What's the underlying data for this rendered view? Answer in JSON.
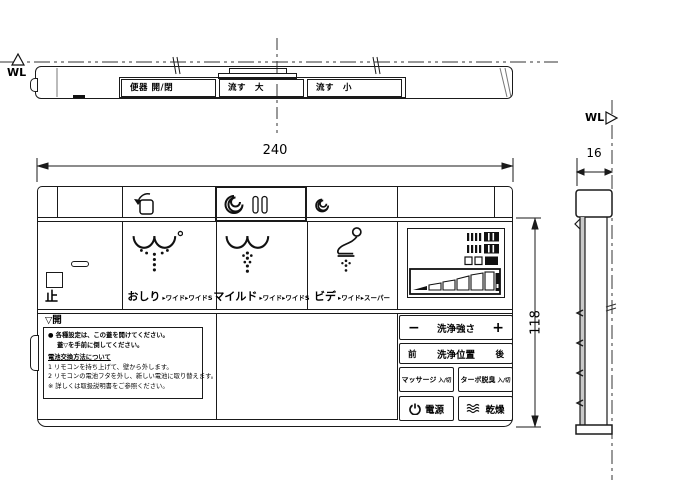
{
  "top_view": {
    "wl_label": "WL",
    "flush_buttons": [
      {
        "label": "便器 開/閉"
      },
      {
        "label": "流す　大"
      },
      {
        "label": "流す　小"
      }
    ]
  },
  "front_view": {
    "dim_width": "240",
    "dim_height": "118",
    "stop_label": "止",
    "wash_buttons": [
      {
        "label": "おしり",
        "modes": "▸ワイド▸ワイドS"
      },
      {
        "label": "マイルド",
        "modes": "▸ワイド▸ワイドS"
      },
      {
        "label": "ビデ",
        "modes": "▸ワイド▸スーパー"
      }
    ],
    "panel": {
      "minus": "−",
      "strength_label": "洗浄強さ",
      "plus": "+",
      "front_label": "前",
      "position_label": "洗浄位置",
      "back_label": "後",
      "massage_label": "マッサージ",
      "massage_state": "入/切",
      "turbo_label": "ターボ脱臭",
      "turbo_state": "入/切",
      "power_label": "電源",
      "dry_label": "乾燥"
    },
    "lid": {
      "open_label": "▽開",
      "notice": [
        "● 各種設定は、この蓋を開けてください。",
        "蓋▽を手前に倒してください。",
        "電池交換方法について",
        "1 リモコンを持ち上げて、壁から外します。",
        "2 リモコンの電池フタを外し、新しい電池に取り替えます。",
        "※ 詳しくは取扱説明書をご参照ください。"
      ]
    }
  },
  "side_view": {
    "wl_label": "WL",
    "dim_depth": "16"
  },
  "icons": {
    "wl-datum-up-icon": "△",
    "wl-datum-right-icon": "▷",
    "toilet-lid-icon": "toilet open/close with arrow",
    "flush-large-icon": "swirl + two bars",
    "flush-small-icon": "small swirl",
    "stop-icon": "□ outline square",
    "stop-slot-shape": "rounded slot",
    "oshiri-spray-icon": "seat arcs with spray dots",
    "mild-spray-icon": "seat arcs with soft spray dots",
    "bidet-spray-icon": "seated figure with spray dots",
    "power-icon": "power symbol",
    "dry-icon": "warm air waves",
    "level-indicator": "ascending level bar display"
  },
  "colors": {
    "line": "#1a1a1a",
    "shade": "#c9c9c9",
    "background": "#ffffff"
  }
}
